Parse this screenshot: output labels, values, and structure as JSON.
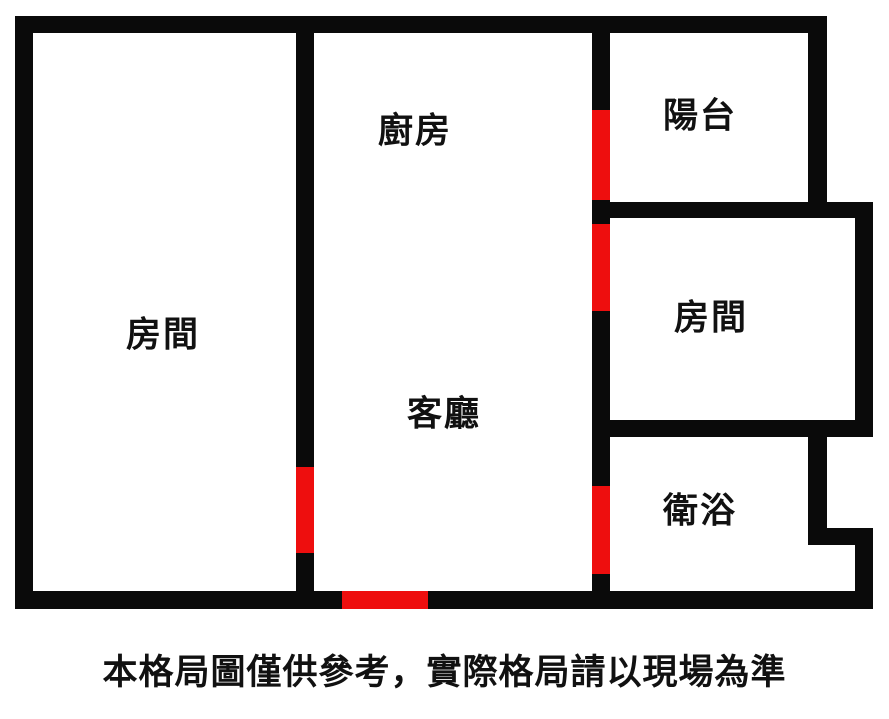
{
  "disclaimer": {
    "text": "本格局圖僅供參考，實際格局請以現場為準"
  },
  "colors": {
    "wall": "#0a0a0a",
    "door": "#ee0e0e",
    "text": "#111111",
    "background": "#ffffff"
  },
  "floorplan": {
    "width": 889,
    "height": 640,
    "rooms": [
      {
        "name": "bedroom-left",
        "label": "房間",
        "cx": 163,
        "cy": 335
      },
      {
        "name": "kitchen",
        "label": "廚房",
        "cx": 415,
        "cy": 131
      },
      {
        "name": "living-room",
        "label": "客廳",
        "cx": 444,
        "cy": 414
      },
      {
        "name": "balcony",
        "label": "陽台",
        "cx": 700,
        "cy": 116
      },
      {
        "name": "bedroom-right",
        "label": "房間",
        "cx": 711,
        "cy": 318
      },
      {
        "name": "bathroom",
        "label": "衛浴",
        "cx": 700,
        "cy": 511
      }
    ],
    "walls": [
      {
        "name": "wall-top",
        "x": 15,
        "y": 16,
        "w": 812,
        "h": 17
      },
      {
        "name": "wall-left",
        "x": 15,
        "y": 16,
        "w": 18,
        "h": 593
      },
      {
        "name": "wall-bottom",
        "x": 15,
        "y": 591,
        "w": 858,
        "h": 18
      },
      {
        "name": "wall-bedroom-left-divider",
        "x": 296,
        "y": 16,
        "w": 18,
        "h": 593
      },
      {
        "name": "wall-center-divider",
        "x": 592,
        "y": 16,
        "w": 18,
        "h": 593
      },
      {
        "name": "wall-balcony-right",
        "x": 808,
        "y": 16,
        "w": 19,
        "h": 202
      },
      {
        "name": "wall-balcony-bottom",
        "x": 592,
        "y": 202,
        "w": 281,
        "h": 16
      },
      {
        "name": "wall-outer-right-upper",
        "x": 855,
        "y": 202,
        "w": 18,
        "h": 234
      },
      {
        "name": "wall-bedroom-right-bathroom-divider",
        "x": 592,
        "y": 420,
        "w": 281,
        "h": 17
      },
      {
        "name": "wall-bathroom-right",
        "x": 808,
        "y": 420,
        "w": 19,
        "h": 125
      },
      {
        "name": "wall-bathroom-step",
        "x": 808,
        "y": 528,
        "w": 65,
        "h": 17
      },
      {
        "name": "wall-outer-right-lower",
        "x": 855,
        "y": 528,
        "w": 18,
        "h": 81
      }
    ],
    "doors": [
      {
        "name": "door-balcony",
        "x": 592,
        "y": 110,
        "w": 18,
        "h": 90
      },
      {
        "name": "door-bedroom-right",
        "x": 592,
        "y": 224,
        "w": 18,
        "h": 87
      },
      {
        "name": "door-bathroom",
        "x": 592,
        "y": 486,
        "w": 18,
        "h": 88
      },
      {
        "name": "door-bedroom-left",
        "x": 296,
        "y": 467,
        "w": 18,
        "h": 86
      },
      {
        "name": "door-main-entrance",
        "x": 342,
        "y": 591,
        "w": 86,
        "h": 18
      }
    ]
  }
}
